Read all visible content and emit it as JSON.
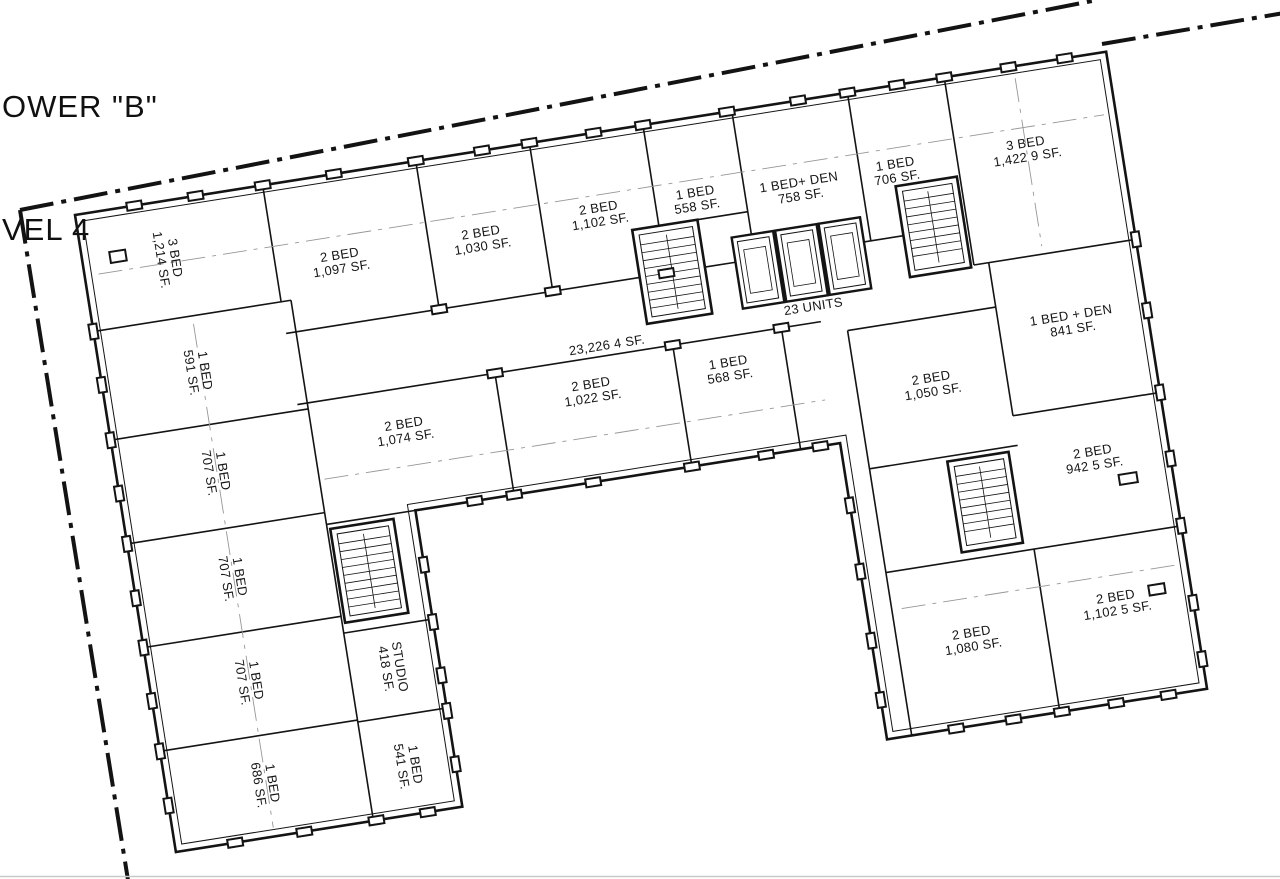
{
  "title": {
    "line1": "OWER \"B\"",
    "line2": "VEL 4"
  },
  "colors": {
    "ink": "#141414",
    "paper": "#ffffff",
    "grid": "#979797"
  },
  "plan": {
    "total_area_label": "23,226 4 SF.",
    "unit_count_label": "23 UNITS",
    "units": [
      {
        "type": "3 BED",
        "area": "1,214 SF."
      },
      {
        "type": "2 BED",
        "area": "1,097 SF."
      },
      {
        "type": "2 BED",
        "area": "1,030 SF."
      },
      {
        "type": "2 BED",
        "area": "1,102 SF."
      },
      {
        "type": "1 BED",
        "area": "558 SF."
      },
      {
        "type": "1 BED+ DEN",
        "area": "758 SF."
      },
      {
        "type": "1 BED",
        "area": "706 SF."
      },
      {
        "type": "3 BED",
        "area": "1,422 9 SF."
      },
      {
        "type": "2 BED",
        "area": "1,074 SF."
      },
      {
        "type": "2 BED",
        "area": "1,022 SF."
      },
      {
        "type": "1 BED",
        "area": "568 SF."
      },
      {
        "type": "2 BED",
        "area": "1,050 SF."
      },
      {
        "type": "1 BED + DEN",
        "area": "841 SF."
      },
      {
        "type": "2 BED",
        "area": "942 5 SF."
      },
      {
        "type": "2 BED",
        "area": "1,080 SF."
      },
      {
        "type": "2 BED",
        "area": "1,102 5 SF."
      },
      {
        "type": "1 BED",
        "area": "591 SF."
      },
      {
        "type": "1 BED",
        "area": "707 SF."
      },
      {
        "type": "1 BED",
        "area": "707 SF."
      },
      {
        "type": "1 BED",
        "area": "707 SF."
      },
      {
        "type": "1 BED",
        "area": "686 SF."
      },
      {
        "type": "STUDIO",
        "area": "418 SF."
      },
      {
        "type": "1 BED",
        "area": "541 SF."
      }
    ]
  }
}
